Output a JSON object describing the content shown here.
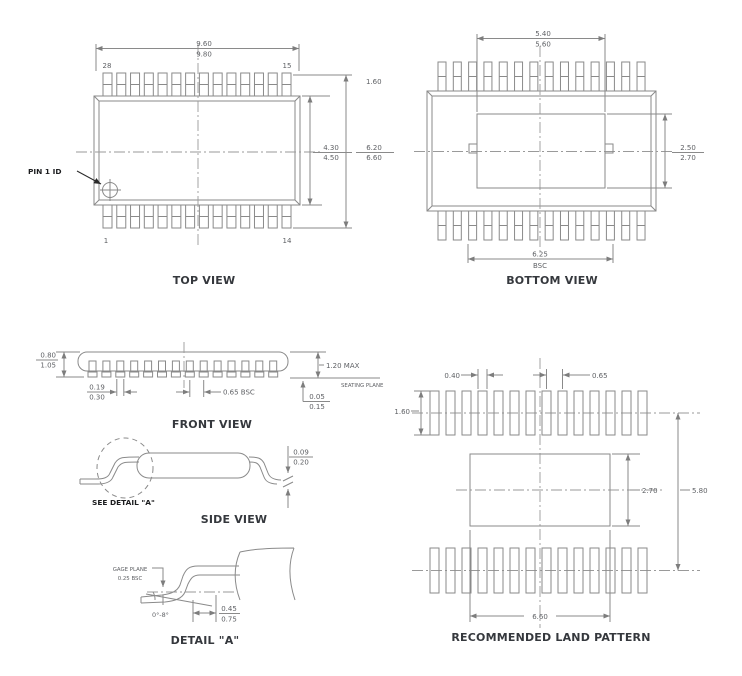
{
  "views": {
    "top": {
      "title": "TOP VIEW",
      "pin1_label": "PIN 1 ID",
      "pins": {
        "top_left": "28",
        "top_right": "15",
        "bottom_left": "1",
        "bottom_right": "14"
      },
      "dim_width": {
        "a": "9.60",
        "b": "9.80"
      },
      "dim_lead": "1.60",
      "dim_body_h": {
        "a": "4.30",
        "b": "4.50"
      },
      "dim_overall_h": {
        "a": "6.20",
        "b": "6.60"
      }
    },
    "bottom": {
      "title": "BOTTOM VIEW",
      "dim_pad_w": {
        "a": "5.40",
        "b": "5.60"
      },
      "dim_pad_h": {
        "a": "2.50",
        "b": "2.70"
      },
      "dim_span": {
        "a": "6.25",
        "b": "BSC"
      }
    },
    "front": {
      "title": "FRONT VIEW",
      "dim_body": {
        "a": "0.80",
        "b": "1.05"
      },
      "dim_height": "1.20 MAX",
      "seating_plane": "SEATING PLANE",
      "dim_lead_w": {
        "a": "0.19",
        "b": "0.30"
      },
      "dim_pitch": "0.65 BSC",
      "dim_standoff": {
        "a": "0.05",
        "b": "0.15"
      }
    },
    "side": {
      "title": "SIDE VIEW",
      "see_detail": "SEE DETAIL \"A\"",
      "dim_lead_t": {
        "a": "0.09",
        "b": "0.20"
      }
    },
    "detail": {
      "title": "DETAIL \"A\"",
      "gage_plane": "GAGE PLANE",
      "gage_offset": "0.25 BSC",
      "angle": "0°-8°",
      "dim_foot": {
        "a": "0.45",
        "b": "0.75"
      }
    },
    "land": {
      "title": "RECOMMENDED LAND PATTERN",
      "dim_pad_w": "0.40",
      "dim_pitch": "0.65",
      "dim_pad_l": "1.60",
      "dim_center_h": "2.70",
      "dim_overall": "5.80",
      "dim_center_w": "6.60"
    }
  }
}
